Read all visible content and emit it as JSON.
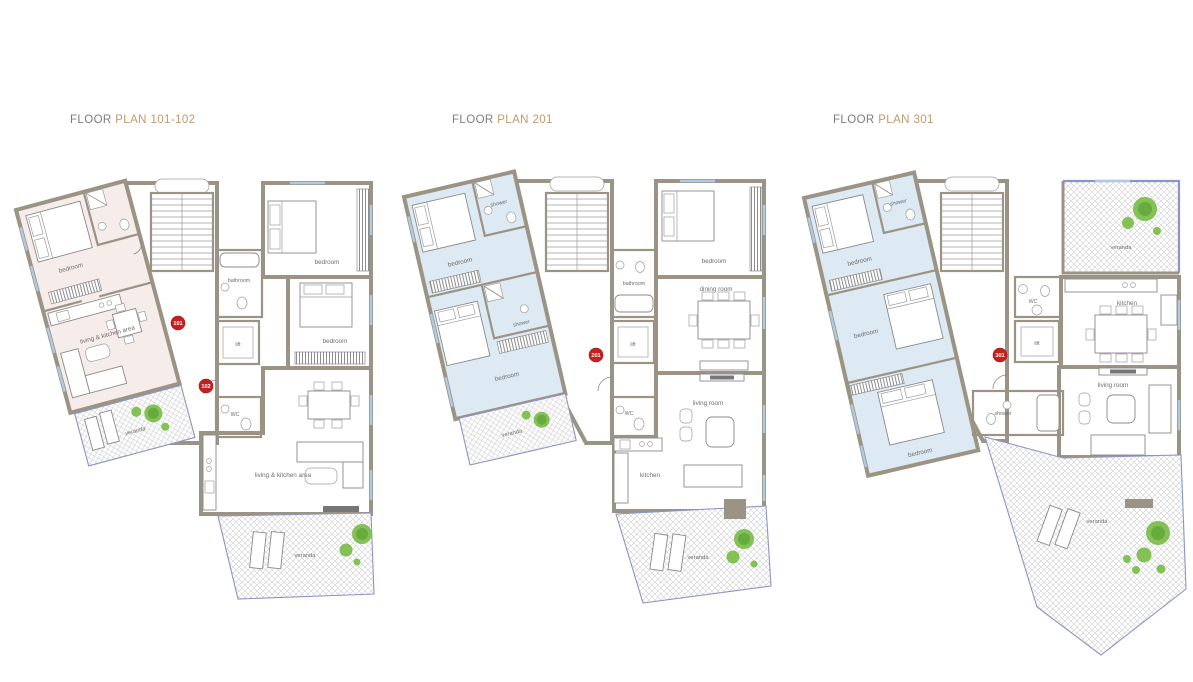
{
  "colors": {
    "title_gray": "#7c7c7c",
    "title_accent": "#c1996b",
    "wall": "#9b9384",
    "floor_blue": "#dde9f3",
    "floor_pink": "#f6ecea",
    "badge_red": "#c32120",
    "tree_green": "#79bd47",
    "veranda_rail_blue": "#8d95c6",
    "window_blue": "#aecbe2"
  },
  "plans": [
    {
      "title": {
        "prefix": "FLOOR",
        "name": "PLAN 101-102"
      },
      "badges": [
        {
          "label": "101"
        },
        {
          "label": "102"
        }
      ],
      "rooms": {
        "bedroom_a": "bedroom",
        "living_a": "living & kitchen area",
        "veranda_a": "veranda",
        "bedroom_b": "bedroom",
        "bedroom_c": "bedroom",
        "bathroom": "bathroom",
        "lift": "lift",
        "wc": "WC",
        "living_b": "living & kitchen area",
        "veranda_b": "veranda"
      }
    },
    {
      "title": {
        "prefix": "FLOOR",
        "name": "PLAN 201"
      },
      "badges": [
        {
          "label": "201"
        }
      ],
      "rooms": {
        "bedroom_a": "bedroom",
        "shower_a": "shower",
        "shower_b": "shower",
        "bedroom_b": "bedroom",
        "veranda_a": "veranda",
        "bedroom_c": "bedroom",
        "bathroom": "bathroom",
        "dining": "dining room",
        "lift": "lift",
        "wc": "WC",
        "kitchen": "kitchen",
        "living": "living room",
        "veranda_b": "veranda"
      }
    },
    {
      "title": {
        "prefix": "FLOOR",
        "name": "PLAN 301"
      },
      "badges": [
        {
          "label": "301"
        }
      ],
      "rooms": {
        "shower_a": "shower",
        "bedroom_a": "bedroom",
        "bedroom_b": "bedroom",
        "bedroom_c": "bedroom",
        "shower_b": "shower",
        "veranda_a": "veranda",
        "wc": "WC",
        "kitchen": "kitchen",
        "lift": "lift",
        "living": "living room",
        "veranda_b": "veranda"
      }
    }
  ]
}
